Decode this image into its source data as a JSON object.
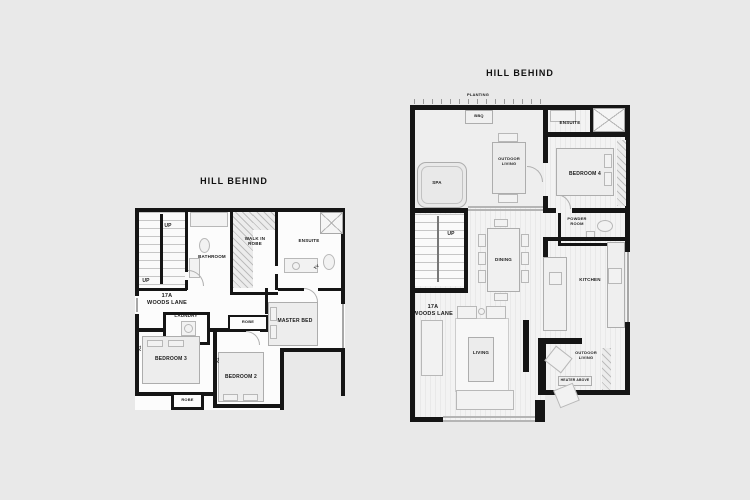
{
  "colors": {
    "background": "#e9e9e9",
    "wall": "#151515",
    "floor": "#fcfcfc",
    "deck": "#f3f3f3",
    "furniture_border": "#adadad",
    "text": "#1b1b1b"
  },
  "left_plan": {
    "title": "HILL BEHIND",
    "address_line1": "17A",
    "address_line2": "WOODS LANE",
    "labels": {
      "up_top": "UP",
      "up_bottom": "UP",
      "bathroom": "BATHROOM",
      "walk_in_robe": "WALK IN\nROBE",
      "ensuite": "ENSUITE",
      "tv_ensuite": "TV",
      "laundry": "LAUNDRY",
      "robe_hall": "ROBE",
      "master_bed": "MASTER BED",
      "bedroom_2": "BEDROOM 2",
      "bedroom_3": "BEDROOM 3",
      "robe_rear": "ROBE",
      "tv_bed3": "TV",
      "tv_bed2": "TV"
    }
  },
  "right_plan": {
    "title": "HILL BEHIND",
    "address_line1": "17A",
    "address_line2": "WOODS LANE",
    "labels": {
      "planting": "PLANTING",
      "bbq": "BBQ",
      "spa": "SPA",
      "outdoor_living_upper": "OUTDOOR\nLIVING",
      "ensuite": "ENSUITE",
      "bedroom_4": "BEDROOM 4",
      "powder_room": "POWDER\nROOM",
      "up": "UP",
      "dining": "DINING",
      "kitchen": "KITCHEN",
      "living": "LIVING",
      "outdoor_living_lower": "OUTDOOR\nLIVING",
      "heater_above": "HEATER ABOVE"
    }
  }
}
